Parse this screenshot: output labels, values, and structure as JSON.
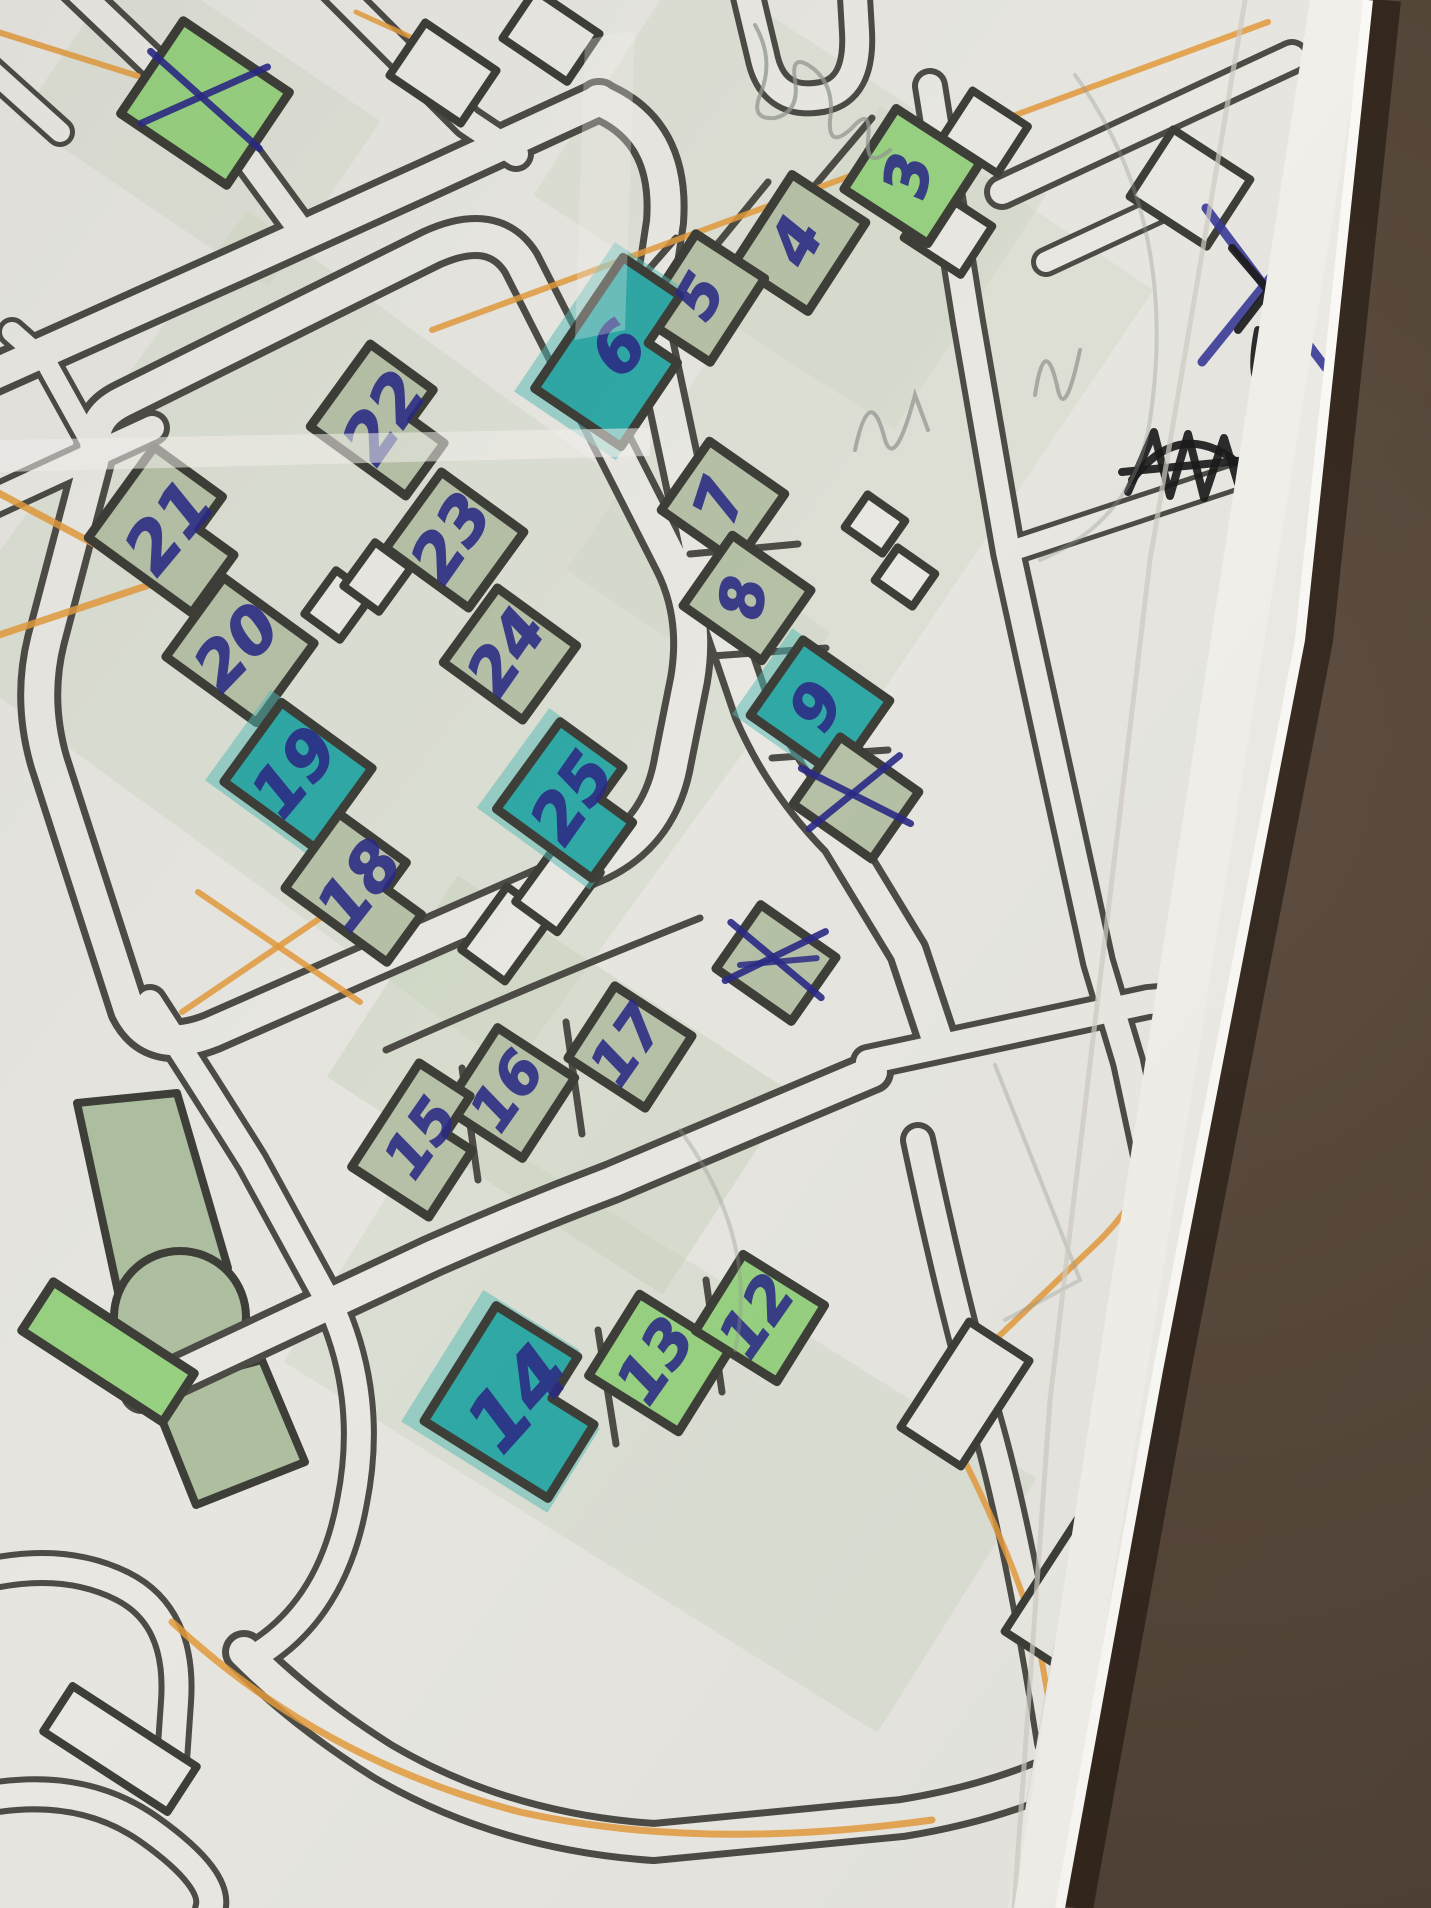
{
  "meta": {
    "description": "Photograph of a hand-annotated printed street map lying on a dark brown leather surface. Buildings are numbered in blue ballpoint pen; some are highlighted with teal marker, some crossed out with X marks; an orange pencil route crosses the map.",
    "domain": "map-photo"
  },
  "colors": {
    "photo_bg": "#493b30",
    "photo_bg_light": "#5e4e41",
    "paper": "#eceae4",
    "print": "#e6e5df",
    "margin": "#f1efe9",
    "road": "#4c4b45",
    "road_fill": "#e8e7e1",
    "building_stroke": "#3e3e38",
    "sage": "#b5c0a6",
    "green": "#97d080",
    "teal": "#2fa8a6",
    "teal_halo": "#52bab4",
    "ink": "#2b2a85",
    "black_ink": "#1b1b1b",
    "pencil": "#939892",
    "orange": "#e29a3c",
    "crease": "#f4f3ee",
    "edge_light": "#faf9f5"
  },
  "paper_polygon": "0,0 1368,0 1300,640 1158,1370 1060,1908 0,1908",
  "print_polygon": "0,0 1312,0 1244,640 1102,1370 1008,1908 0,1908",
  "margin_polygon": "1310,0 1368,0 1060,1908 1014,1908",
  "map": {
    "numbered_buildings_visible": [
      "3",
      "4",
      "5",
      "6",
      "7",
      "8",
      "9",
      "12",
      "13",
      "14",
      "15",
      "16",
      "17",
      "18",
      "19",
      "20",
      "21",
      "22",
      "23",
      "24",
      "25"
    ],
    "highlighted_teal": [
      "6",
      "9",
      "14",
      "19",
      "25"
    ],
    "crossed_out_unnumbered": 3,
    "buildings": [
      {
        "id": "x-a",
        "label": "",
        "cx": 205,
        "cy": 103,
        "w": 128,
        "h": 112,
        "rot": 34,
        "fill": "green",
        "mark": "x"
      },
      {
        "id": "b3",
        "label": "3",
        "cx": 912,
        "cy": 176,
        "w": 100,
        "h": 96,
        "rot": 33,
        "fill": "green",
        "lrot": -78,
        "fs": 60
      },
      {
        "id": "b4",
        "label": "4",
        "cx": 800,
        "cy": 243,
        "w": 88,
        "h": 106,
        "rot": 33,
        "fill": "sage",
        "lrot": -62,
        "fs": 62
      },
      {
        "id": "b5",
        "label": "5",
        "cx": 703,
        "cy": 298,
        "w": 82,
        "h": 100,
        "rot": 33,
        "fill": "sage",
        "lrot": -60,
        "fs": 58
      },
      {
        "id": "b6",
        "label": "6",
        "cx": 622,
        "cy": 352,
        "w": 104,
        "h": 158,
        "rot": 34,
        "fill": "teal",
        "shape": "L",
        "lrot": -48,
        "fs": 66
      },
      {
        "id": "b7",
        "label": "7",
        "cx": 723,
        "cy": 502,
        "w": 92,
        "h": 84,
        "rot": 35,
        "fill": "sage",
        "lrot": -72,
        "fs": 60
      },
      {
        "id": "b8",
        "label": "8",
        "cx": 747,
        "cy": 598,
        "w": 96,
        "h": 86,
        "rot": 35,
        "fill": "sage",
        "lrot": -82,
        "fs": 60
      },
      {
        "id": "b9",
        "label": "9",
        "cx": 820,
        "cy": 708,
        "w": 106,
        "h": 92,
        "rot": 35,
        "fill": "teal",
        "lrot": -60,
        "fs": 62
      },
      {
        "id": "x-b",
        "label": "",
        "cx": 856,
        "cy": 798,
        "w": 96,
        "h": 82,
        "rot": 35,
        "fill": "sage",
        "mark": "x"
      },
      {
        "id": "x-c",
        "label": "",
        "cx": 776,
        "cy": 963,
        "w": 92,
        "h": 78,
        "rot": 35,
        "fill": "sage",
        "mark": "xx"
      },
      {
        "id": "b22",
        "label": "22",
        "cx": 388,
        "cy": 420,
        "w": 118,
        "h": 102,
        "rot": 36,
        "fill": "sage",
        "shape": "L",
        "lrot": -55,
        "fs": 66
      },
      {
        "id": "b21",
        "label": "21",
        "cx": 173,
        "cy": 530,
        "w": 128,
        "h": 112,
        "rot": 36,
        "fill": "sage",
        "shape": "L",
        "lrot": -50,
        "fs": 68
      },
      {
        "id": "b23",
        "label": "23",
        "cx": 455,
        "cy": 540,
        "w": 102,
        "h": 94,
        "rot": 36,
        "fill": "sage",
        "lrot": -55,
        "fs": 64
      },
      {
        "id": "b20",
        "label": "20",
        "cx": 240,
        "cy": 650,
        "w": 112,
        "h": 98,
        "rot": 36,
        "fill": "sage",
        "lrot": -46,
        "fs": 64
      },
      {
        "id": "b24",
        "label": "24",
        "cx": 510,
        "cy": 654,
        "w": 98,
        "h": 92,
        "rot": 36,
        "fill": "sage",
        "lrot": -55,
        "fs": 62
      },
      {
        "id": "b19",
        "label": "19",
        "cx": 298,
        "cy": 775,
        "w": 112,
        "h": 98,
        "rot": 36,
        "fill": "teal",
        "lrot": -50,
        "fs": 66
      },
      {
        "id": "b25",
        "label": "25",
        "cx": 576,
        "cy": 800,
        "w": 118,
        "h": 108,
        "rot": 36,
        "fill": "teal",
        "shape": "L",
        "lrot": -55,
        "fs": 66
      },
      {
        "id": "b18",
        "label": "18",
        "cx": 363,
        "cy": 888,
        "w": 126,
        "h": 92,
        "rot": 36,
        "fill": "sage",
        "shape": "L",
        "lrot": -52,
        "fs": 66
      },
      {
        "id": "b17",
        "label": "17",
        "cx": 630,
        "cy": 1047,
        "w": 92,
        "h": 86,
        "rot": 33,
        "fill": "sage",
        "lrot": -55,
        "fs": 58
      },
      {
        "id": "b16",
        "label": "16",
        "cx": 510,
        "cy": 1093,
        "w": 92,
        "h": 96,
        "rot": 33,
        "fill": "sage",
        "lrot": -55,
        "fs": 58
      },
      {
        "id": "b15",
        "label": "15",
        "cx": 424,
        "cy": 1140,
        "w": 92,
        "h": 124,
        "rot": 33,
        "fill": "sage",
        "shape": "L",
        "lrot": -55,
        "fs": 58
      },
      {
        "id": "b14",
        "label": "14",
        "cx": 522,
        "cy": 1402,
        "w": 146,
        "h": 136,
        "rot": 32,
        "fill": "teal",
        "shape": "L",
        "lrot": -48,
        "fs": 78
      },
      {
        "id": "b13",
        "label": "13",
        "cx": 659,
        "cy": 1363,
        "w": 106,
        "h": 96,
        "rot": 32,
        "fill": "green",
        "lrot": -55,
        "fs": 62
      },
      {
        "id": "b12",
        "label": "12",
        "cx": 760,
        "cy": 1318,
        "w": 96,
        "h": 90,
        "rot": 32,
        "fill": "green",
        "lrot": -55,
        "fs": 60
      },
      {
        "id": "strip",
        "label": "",
        "cx": 108,
        "cy": 1352,
        "w": 168,
        "h": 58,
        "rot": 33,
        "fill": "green"
      }
    ],
    "outline_buildings": [
      [
        443,
        73,
        86,
        64,
        34
      ],
      [
        551,
        36,
        78,
        58,
        34
      ],
      [
        985,
        132,
        66,
        56,
        33
      ],
      [
        1190,
        188,
        92,
        80,
        33
      ],
      [
        875,
        524,
        46,
        40,
        35
      ],
      [
        905,
        577,
        46,
        40,
        35
      ],
      [
        338,
        605,
        44,
        54,
        36
      ],
      [
        377,
        577,
        44,
        54,
        36
      ],
      [
        506,
        934,
        54,
        78,
        36
      ],
      [
        558,
        887,
        52,
        74,
        36
      ],
      [
        965,
        1394,
        72,
        126,
        33
      ],
      [
        1086,
        1596,
        98,
        148,
        33
      ],
      [
        1120,
        1854,
        104,
        84,
        32
      ],
      [
        1205,
        1069,
        64,
        120,
        34
      ],
      [
        120,
        1749,
        148,
        54,
        33
      ],
      [
        948,
        232,
        68,
        58,
        33
      ]
    ],
    "roads": [
      {
        "d": "M -30 385 L 245 262 Q 338 220 428 179 L 600 100",
        "w": 1
      },
      {
        "d": "M -30 512 L 152 428",
        "w": 2
      },
      {
        "d": "M 598 100 Q 672 130 665 222 L 650 322",
        "w": 1
      },
      {
        "d": "M 744 -20 L 762 55 Q 772 106 822 97 Q 860 90 857 32 L 854 -20",
        "w": 2
      },
      {
        "d": "M 650 322 L 700 556 L 753 712 Q 783 782 840 840 L 908 952 L 938 1042",
        "w": 1
      },
      {
        "d": "M 930 86 L 968 322 L 1008 552 L 1054 762 L 1098 962 L 1128 1062",
        "w": 2
      },
      {
        "d": "M 96 450 Q 90 418 122 402 L 432 248 Q 494 220 521 263 L 673 562 Q 700 615 689 680 L 673 760 Q 661 831 601 861 L 212 1032 Q 152 1056 129 1010 L 49 762 Q 31 700 46 640 Z",
        "w": 1
      },
      {
        "d": "M 142 1392 L 432 1256 Q 522 1216 612 1182 L 872 1072",
        "w": 1
      },
      {
        "d": "M 868 1062 L 1148 1002 L 1312 988",
        "w": 2
      },
      {
        "d": "M 150 1002 Q 202 1082 252 1162 L 334 1312 Q 372 1402 352 1502 Q 332 1612 252 1658",
        "w": 2
      },
      {
        "d": "M 244 1652 Q 304 1712 384 1762 Q 504 1832 654 1842 L 902 1818 Q 1002 1802 1082 1762 L 1302 1652",
        "w": 1
      },
      {
        "d": "M 1128 1062 L 1186 1332 Q 1206 1432 1262 1502",
        "w": 2
      },
      {
        "d": "M 1312 1532 Q 1202 1642 1142 1792 L 1116 1910",
        "w": 2
      },
      {
        "d": "M 1002 192 L 1292 57",
        "w": 2
      },
      {
        "d": "M 70 -16 L 236 142 L 302 232",
        "w": 2
      },
      {
        "d": "M 326 -20 L 468 122 L 516 154",
        "w": 2
      },
      {
        "d": "M 96 452 L 46 362 L 12 332",
        "w": 3
      },
      {
        "d": "M -20 1576 Q 62 1556 122 1586 Q 182 1616 176 1702 L 172 1760",
        "w": 2
      },
      {
        "d": "M -20 1800 Q 80 1780 150 1830 Q 220 1880 210 1910",
        "w": 2
      },
      {
        "d": "M 1046 262 L 1188 196",
        "w": 3
      },
      {
        "d": "M 1008 552 L 1256 470",
        "w": 3
      },
      {
        "d": "M 918 1140 Q 952 1300 986 1420 Q 1020 1540 1052 1742",
        "w": 2
      },
      {
        "d": "M -20 60 L 60 132",
        "w": 3
      }
    ],
    "minor_lines": [
      "M 872 118 L 806 196",
      "M 768 182 L 706 258",
      "M 676 238 L 622 300",
      "M 690 554 L 798 544",
      "M 712 656 L 826 648",
      "M 772 758 L 888 750",
      "M 706 1280 L 722 1392",
      "M 598 1330 L 616 1444",
      "M 462 1068 L 478 1180",
      "M 566 1022 L 582 1134",
      "M 386 1050 Q 520 990 700 918"
    ],
    "orange_lines": [
      {
        "d": "M -22 482 L 158 578",
        "w": 7
      },
      {
        "d": "M -22 642 L 158 582",
        "w": 7
      },
      {
        "d": "M 182 1012 L 344 902",
        "w": 6
      },
      {
        "d": "M 198 892 L 360 1002",
        "w": 6
      },
      {
        "d": "M 432 330 L 1268 22",
        "w": 6
      },
      {
        "d": "M 1298 152 L 1160 1128 Q 1150 1190 1100 1240 L 932 1400",
        "w": 6
      },
      {
        "d": "M 932 1400 Q 1000 1520 1038 1640 L 1058 1752",
        "w": 6
      },
      {
        "d": "M 172 1622 Q 320 1760 520 1812 Q 700 1852 932 1820",
        "w": 7
      },
      {
        "d": "M -15 28 L 138 76",
        "w": 6
      },
      {
        "d": "M 356 12 L 470 64",
        "w": 5
      }
    ],
    "tints": [
      [
        560,
        1085,
        400,
        240,
        33,
        0.45
      ],
      [
        660,
        1420,
        700,
        300,
        32,
        0.32
      ],
      [
        860,
        430,
        330,
        560,
        34,
        0.28
      ],
      [
        380,
        640,
        720,
        540,
        36,
        0.33
      ],
      [
        790,
        195,
        430,
        280,
        33,
        0.28
      ],
      [
        200,
        120,
        300,
        200,
        34,
        0.28
      ]
    ],
    "park": {
      "polys": [
        [
          [
            77,
            1103
          ],
          [
            177,
            1093
          ],
          [
            228,
            1268
          ],
          [
            118,
            1292
          ]
        ],
        [
          [
            150,
            1390
          ],
          [
            262,
            1360
          ],
          [
            305,
            1462
          ],
          [
            196,
            1505
          ]
        ]
      ],
      "circle": {
        "cx": 180,
        "cy": 1317,
        "r": 66
      }
    }
  },
  "annotations": {
    "blue_building_crosses": [
      {
        "x": 205,
        "y": 100,
        "l": 62,
        "rot": 10,
        "heavy": false
      },
      {
        "x": 856,
        "y": 796,
        "l": 52,
        "rot": -5,
        "heavy": false
      },
      {
        "x": 776,
        "y": 960,
        "l": 50,
        "rot": 8,
        "heavy": true
      }
    ],
    "blue_pen_paths": [
      "M 1206 208 L 1326 368",
      "M 1322 214 L 1202 362"
    ],
    "black_pen_paths": [
      "M 1128 492 L 1154 432 L 1170 496 L 1188 434 L 1204 498 L 1224 438 L 1240 490",
      "M 1122 472 L 1248 460",
      "M 1132 480 Q 1182 414 1244 468",
      "M 1232 248 L 1304 332",
      "M 1298 252 L 1238 330",
      "M 1258 330 Q 1246 390 1272 398"
    ],
    "pencil_paths": [
      "M 755 25 Q 775 60 760 95 Q 750 120 775 118 Q 800 112 795 80 Q 790 50 815 70 Q 835 88 830 120 Q 828 150 852 128 Q 872 105 868 140 Q 866 170 890 150",
      "M 855 450 Q 870 380 885 440 Q 895 470 915 395 L 928 430",
      "M 1035 395 Q 1045 330 1058 390 Q 1065 420 1080 350",
      "M 1075 75 Q 1180 220 1150 420 Q 1135 520 1040 560",
      "M 995 1065 L 1080 1280 L 1005 1320",
      "M 680 1130 Q 760 1240 735 1350"
    ],
    "pencil_labels": [
      {
        "text": "ооо",
        "x": 1252,
        "y": 1402,
        "rot": -68,
        "fs": 40,
        "opacity": 0.55
      },
      {
        "text": "300",
        "x": 1262,
        "y": 1498,
        "rot": -68,
        "fs": 44,
        "opacity": 0.75
      }
    ]
  }
}
